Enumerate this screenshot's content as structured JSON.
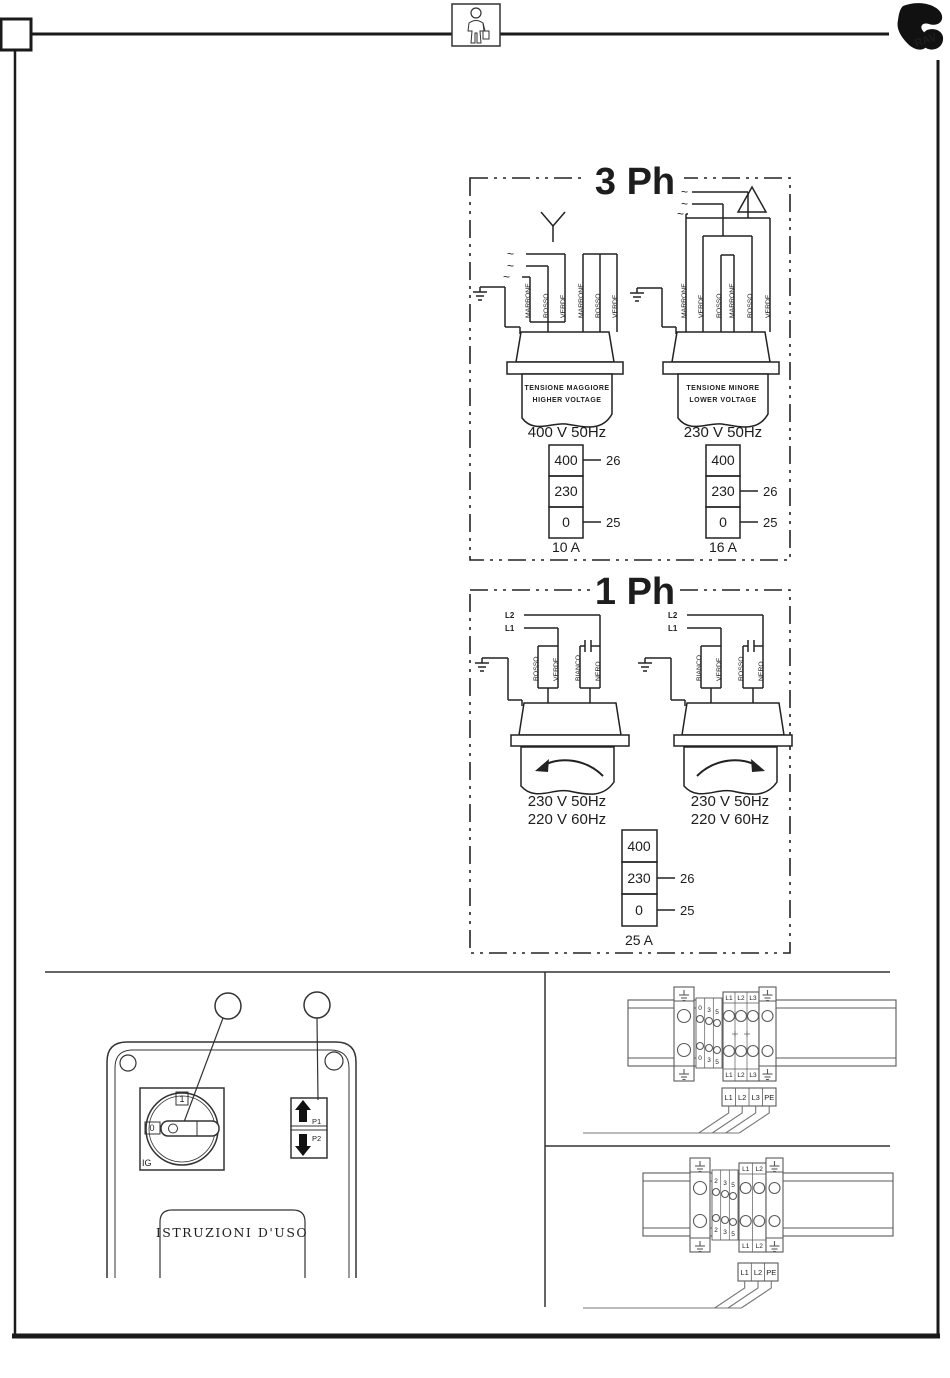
{
  "frame": {
    "logo_text": "RAV"
  },
  "three_phase": {
    "title": "3 Ph",
    "phase_marks": [
      "~",
      "~",
      "~"
    ],
    "star": {
      "wires": [
        "MARRONE",
        "ROSSO",
        "VERDE",
        "MARRONE",
        "ROSSO",
        "VERDE"
      ],
      "tag1": "TENSIONE MAGGIORE",
      "tag2": "HIGHER VOLTAGE",
      "voltage": "400 V 50Hz",
      "sel": [
        "400",
        "230",
        "0"
      ],
      "tap26": "26",
      "tap25": "25",
      "fuse": "10 A"
    },
    "delta": {
      "wires": [
        "MARRONE",
        "VERDE",
        "ROSSO",
        "MARRONE",
        "ROSSO",
        "VERDE"
      ],
      "tag1": "TENSIONE MINORE",
      "tag2": "LOWER VOLTAGE",
      "voltage": "230 V 50Hz",
      "sel": [
        "400",
        "230",
        "0"
      ],
      "tap26": "26",
      "tap25": "25",
      "fuse": "16 A"
    }
  },
  "one_phase": {
    "title": "1 Ph",
    "left": {
      "l2": "L2",
      "l1": "L1",
      "wires": [
        "ROSSO",
        "VERDE",
        "BIANCO",
        "NERO"
      ],
      "v1": "230 V 50Hz",
      "v2": "220 V 60Hz"
    },
    "right": {
      "l2": "L2",
      "l1": "L1",
      "wires": [
        "BIANCO",
        "VERDE",
        "ROSSO",
        "NERO"
      ],
      "v1": "230 V 50Hz",
      "v2": "220 V 60Hz"
    },
    "sel": [
      "400",
      "230",
      "0"
    ],
    "tap26": "26",
    "tap25": "25",
    "fuse": "25 A"
  },
  "control_panel": {
    "switch_on": "1",
    "switch_off": "0",
    "switch_label": "IG",
    "btn_up": "P1",
    "btn_down": "P2",
    "plate": "ISTRUZIONI D'USO"
  },
  "terminals": {
    "t3": {
      "aux_top": [
        "0",
        "3",
        "5"
      ],
      "aux_bot": [
        "0",
        "3",
        "5"
      ],
      "line_top": [
        "L1",
        "L2",
        "L3"
      ],
      "line_bot": [
        "L1",
        "L2",
        "L3"
      ],
      "strip": [
        "L1",
        "L2",
        "L3",
        "PE"
      ]
    },
    "t1": {
      "aux_top": [
        "2",
        "3",
        "5"
      ],
      "aux_bot": [
        "2",
        "3",
        "5"
      ],
      "line_top": [
        "L1",
        "L2"
      ],
      "line_bot": [
        "L1",
        "L2"
      ],
      "strip": [
        "L1",
        "L2",
        "PE"
      ]
    }
  }
}
